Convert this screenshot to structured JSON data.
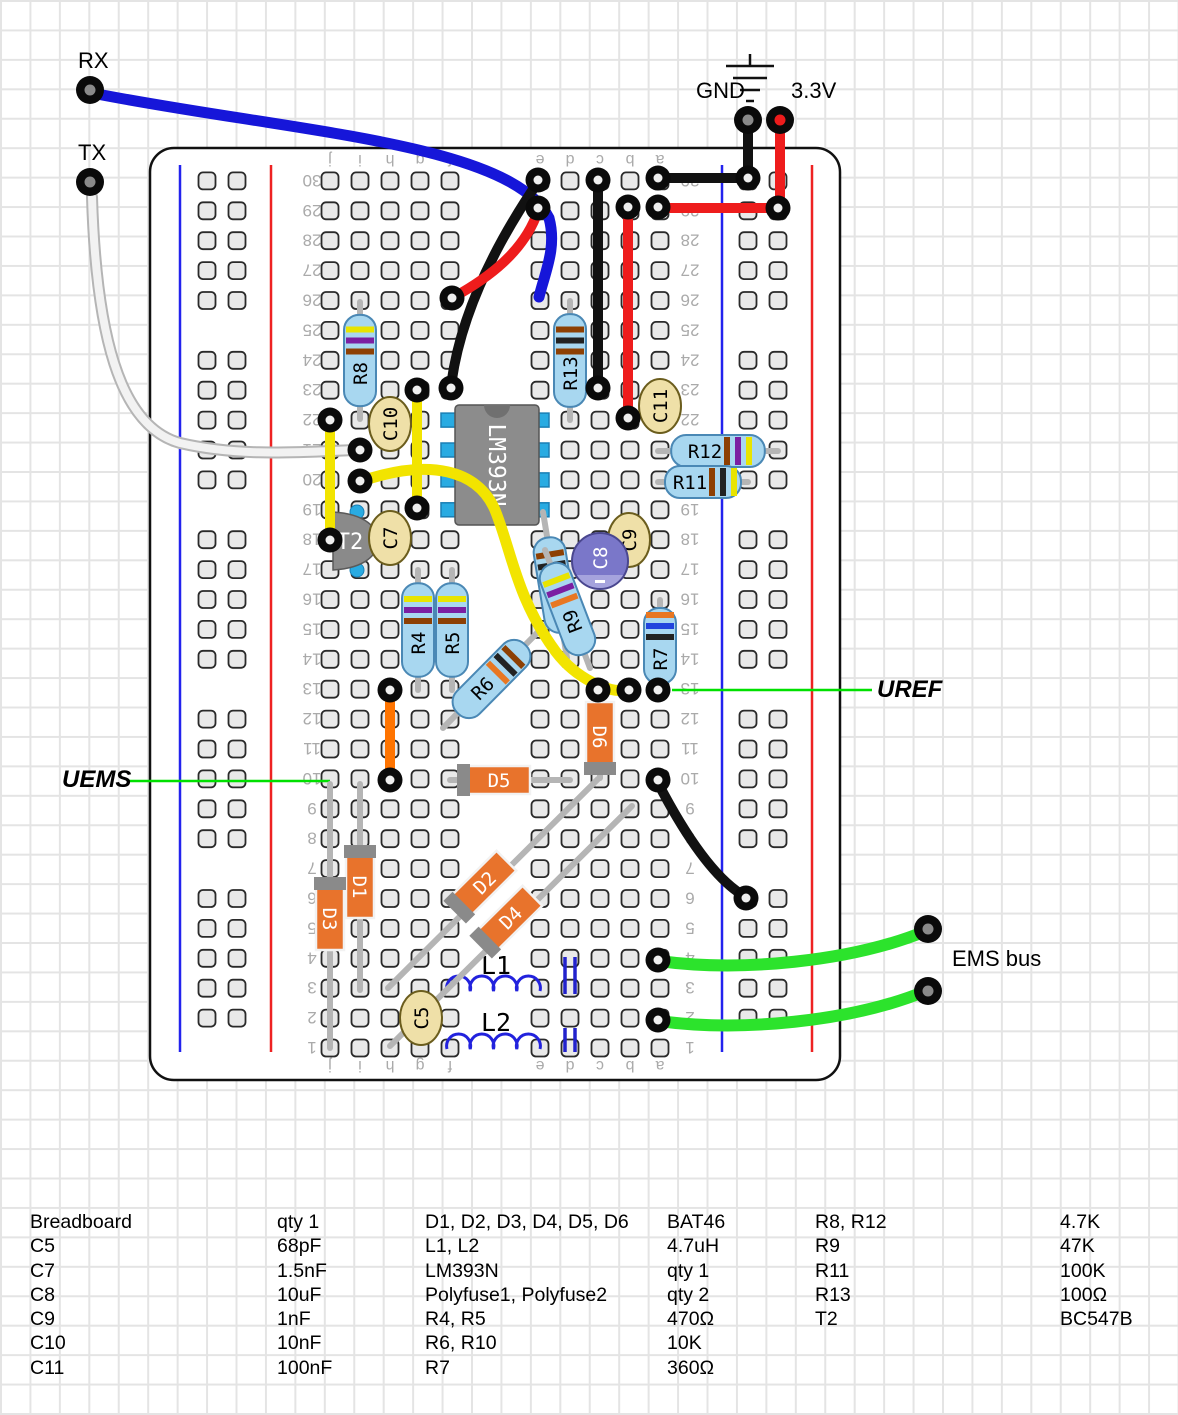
{
  "labels": {
    "rx": "RX",
    "tx": "TX",
    "gnd": "GND",
    "v33": "3.3V",
    "uref": "UREF",
    "uems": "UEMS",
    "ems_bus": "EMS bus"
  },
  "palette": {
    "wire_blue": "#1616d9",
    "wire_red": "#ee1c1c",
    "wire_black": "#111111",
    "wire_yellow": "#f2e400",
    "wire_green": "#2ce32c",
    "wire_orange": "#ff7400",
    "wire_white": "#f2f2f2",
    "annotation_green": "#00e000",
    "resistor_body": "#a8d7f0",
    "diode_body": "#e8732c",
    "cap_film": "#efe0a8",
    "cap_electrolytic": "#7a77c9",
    "ic_body": "#8c8c8c",
    "pin_blue": "#29abe2",
    "rail_blue": "#2222ee",
    "rail_red": "#ee2222"
  },
  "board": {
    "x": 150,
    "y": 148,
    "w": 690,
    "h": 932,
    "row_count": 30,
    "column_letters": [
      "j",
      "i",
      "h",
      "g",
      "f",
      "e",
      "d",
      "c",
      "b",
      "a"
    ]
  },
  "ic": {
    "label": "LM393N",
    "x": 497,
    "y": 465,
    "w": 84,
    "h": 120
  },
  "transistor": {
    "label": "T2",
    "x": 352,
    "y": 541
  },
  "resistors": [
    {
      "label": "R8",
      "p1": [
        360,
        302
      ],
      "p2": [
        360,
        419
      ],
      "side": -1,
      "bands": [
        "#e8e400",
        "#7b1fa2",
        "#8d4004"
      ]
    },
    {
      "label": "R13",
      "p1": [
        570,
        301
      ],
      "p2": [
        570,
        420
      ],
      "side": -1,
      "bands": [
        "#8d4004",
        "#222222",
        "#8d4004"
      ]
    },
    {
      "label": "R12",
      "p1": [
        658,
        451
      ],
      "p2": [
        778,
        451
      ],
      "side": 1,
      "bands": [
        "#8d4004",
        "#7b1fa2",
        "#e8e400"
      ]
    },
    {
      "label": "R11",
      "p1": [
        658,
        482
      ],
      "p2": [
        748,
        482
      ],
      "side": 1,
      "bands": [
        "#8d4004",
        "#222222",
        "#e8e400"
      ]
    },
    {
      "label": "R4",
      "p1": [
        418,
        570
      ],
      "p2": [
        418,
        690
      ],
      "side": -1,
      "bands": [
        "#e8e400",
        "#7b1fa2",
        "#8d4004"
      ]
    },
    {
      "label": "R5",
      "p1": [
        452,
        570
      ],
      "p2": [
        452,
        690
      ],
      "side": -1,
      "bands": [
        "#e8e400",
        "#7b1fa2",
        "#8d4004"
      ]
    },
    {
      "label": "R10",
      "p1": [
        543,
        512
      ],
      "p2": [
        567,
        658
      ],
      "side": -1,
      "bands": [
        "#8d4004",
        "#222222",
        "#e87722"
      ]
    },
    {
      "label": "R9",
      "p1": [
        545,
        550
      ],
      "p2": [
        590,
        668
      ],
      "side": -1,
      "bands": [
        "#e8e400",
        "#7b1fa2",
        "#e87722"
      ]
    },
    {
      "label": "R6",
      "p1": [
        540,
        630
      ],
      "p2": [
        443,
        728
      ],
      "side": -1,
      "bands": [
        "#8d4004",
        "#222222",
        "#e87722"
      ]
    },
    {
      "label": "R7",
      "p1": [
        660,
        600
      ],
      "p2": [
        660,
        692
      ],
      "side": -1,
      "bands": [
        "#e87722",
        "#2244dd",
        "#222222"
      ]
    }
  ],
  "diodes": [
    {
      "label": "D6",
      "p1": [
        600,
        692
      ],
      "p2": [
        600,
        778
      ],
      "bc": [
        600,
        735
      ],
      "band": "p2"
    },
    {
      "label": "D5",
      "p1": [
        450,
        780
      ],
      "p2": [
        570,
        780
      ],
      "bc": [
        497,
        780
      ],
      "band": "p1"
    },
    {
      "label": "D1",
      "p1": [
        360,
        784
      ],
      "p2": [
        360,
        990
      ],
      "bc": [
        360,
        885
      ],
      "band": "p1"
    },
    {
      "label": "D3",
      "p1": [
        330,
        784
      ],
      "p2": [
        330,
        1048
      ],
      "bc": [
        330,
        917
      ],
      "band": "p1"
    },
    {
      "label": "D2",
      "p1": [
        388,
        988
      ],
      "p2": [
        598,
        779
      ],
      "bc": [
        483,
        884
      ],
      "band": "p1"
    },
    {
      "label": "D4",
      "p1": [
        390,
        1046
      ],
      "p2": [
        632,
        806
      ],
      "bc": [
        509,
        919
      ],
      "band": "p1"
    }
  ],
  "capacitors": [
    {
      "label": "C10",
      "x": 390,
      "y": 424,
      "type": "film"
    },
    {
      "label": "C11",
      "x": 660,
      "y": 406,
      "type": "film"
    },
    {
      "label": "C7",
      "x": 390,
      "y": 538,
      "type": "film"
    },
    {
      "label": "C9",
      "x": 629,
      "y": 540,
      "type": "film"
    },
    {
      "label": "C5",
      "x": 421,
      "y": 1018,
      "type": "film"
    },
    {
      "label": "C8",
      "x": 600,
      "y": 561,
      "type": "electrolytic"
    }
  ],
  "inductors": [
    {
      "label": "L1",
      "x1": 447,
      "x2": 540,
      "y": 991,
      "lx": 496,
      "ly": 974
    },
    {
      "label": "L2",
      "x1": 447,
      "x2": 540,
      "y": 1049,
      "lx": 496,
      "ly": 1031
    }
  ],
  "polyfuses": [
    {
      "name": "polyfuse-1",
      "x": 570,
      "y1": 957,
      "y2": 994
    },
    {
      "name": "polyfuse-2",
      "x": 570,
      "y1": 1028,
      "y2": 1052
    }
  ],
  "wires": [
    {
      "name": "wire-rx-blue",
      "color": "#1616d9",
      "w": 11,
      "path": "M92,93 C290,132 510,142 549,218 C557,248 545,272 539,297"
    },
    {
      "name": "wire-tx-white",
      "color": "#f2f2f2",
      "w": 8,
      "outline": "#b5b5b5",
      "path": "M92,197 C96,330 118,426 180,443 C240,457 300,452 355,450"
    },
    {
      "name": "wire-gnd-drop",
      "color": "#111111",
      "w": 10,
      "path": "M748,122 L748,178"
    },
    {
      "name": "wire-gnd-a30",
      "color": "#111111",
      "w": 10,
      "path": "M658,178 L748,178"
    },
    {
      "name": "wire-black-c30-c23",
      "color": "#111111",
      "w": 10,
      "path": "M598,182 L598,388"
    },
    {
      "name": "wire-black-e30-f23",
      "color": "#111111",
      "w": 10,
      "path": "M538,182 C495,245 460,315 451,386"
    },
    {
      "name": "wire-black-a10-rail",
      "color": "#111111",
      "w": 10,
      "path": "M658,783 C685,835 715,880 746,897"
    },
    {
      "name": "wire-33v-drop",
      "color": "#ee1c1c",
      "w": 10,
      "path": "M780,122 L780,206"
    },
    {
      "name": "wire-red-a29-rail",
      "color": "#ee1c1c",
      "w": 10,
      "path": "M658,208 L778,208"
    },
    {
      "name": "wire-red-e29-f26",
      "color": "#ee1c1c",
      "w": 10,
      "path": "M538,211 C524,252 488,278 454,297"
    },
    {
      "name": "wire-red-b29-b22",
      "color": "#ee1c1c",
      "w": 10,
      "path": "M628,210 L628,418"
    },
    {
      "name": "wire-orange-h13-h10",
      "color": "#ff7400",
      "w": 10,
      "path": "M390,692 L390,778"
    },
    {
      "name": "wire-yellow-j22-j18",
      "color": "#f2e400",
      "w": 10,
      "path": "M330,420 L330,540"
    },
    {
      "name": "wire-yellow-g23-g19",
      "color": "#f2e400",
      "w": 10,
      "path": "M417,392 L417,506"
    },
    {
      "name": "wire-yellow-i20-b13",
      "color": "#f2e400",
      "w": 11,
      "path": "M362,481 C430,458 478,470 495,510 C512,552 516,598 556,652 C576,678 608,694 629,690"
    },
    {
      "name": "wire-green-a4-ems",
      "color": "#2ce32c",
      "w": 12,
      "path": "M659,961 C740,972 850,962 926,931"
    },
    {
      "name": "wire-green-a2-ems",
      "color": "#2ce32c",
      "w": 12,
      "path": "M659,1021 C740,1032 850,1022 926,991"
    }
  ],
  "pin_rings": [
    [
      538,
      180
    ],
    [
      538,
      208
    ],
    [
      598,
      180
    ],
    [
      658,
      178
    ],
    [
      748,
      178
    ],
    [
      628,
      207
    ],
    [
      658,
      207
    ],
    [
      778,
      208
    ],
    [
      451,
      388
    ],
    [
      452,
      298
    ],
    [
      598,
      388
    ],
    [
      628,
      418
    ],
    [
      330,
      420
    ],
    [
      330,
      540
    ],
    [
      417,
      390
    ],
    [
      417,
      508
    ],
    [
      360,
      450
    ],
    [
      360,
      481
    ],
    [
      629,
      690
    ],
    [
      658,
      690
    ],
    [
      598,
      690
    ],
    [
      390,
      690
    ],
    [
      390,
      780
    ],
    [
      658,
      780
    ],
    [
      746,
      898
    ],
    [
      658,
      960
    ],
    [
      658,
      1020
    ]
  ],
  "ext_pins": [
    {
      "name": "rx-pin",
      "x": 90,
      "y": 90
    },
    {
      "name": "tx-pin",
      "x": 90,
      "y": 182
    },
    {
      "name": "gnd-pin",
      "x": 748,
      "y": 120
    },
    {
      "name": "v33-pin",
      "x": 780,
      "y": 120
    },
    {
      "name": "ems-pin-1",
      "x": 928,
      "y": 929
    },
    {
      "name": "ems-pin-2",
      "x": 928,
      "y": 991
    }
  ],
  "annotation_lines": [
    {
      "name": "uems-line",
      "x1": 128,
      "y1": 781,
      "x2": 330,
      "y2": 781
    },
    {
      "name": "uref-line",
      "x1": 672,
      "y1": 690,
      "x2": 872,
      "y2": 690
    }
  ],
  "parts_list": [
    {
      "x_name": 30,
      "x_value": 277,
      "rows": [
        [
          "Breadboard",
          "qty 1"
        ],
        [
          "C5",
          "68pF"
        ],
        [
          "C7",
          "1.5nF"
        ],
        [
          "C8",
          "10uF"
        ],
        [
          "C9",
          "1nF"
        ],
        [
          "C10",
          "10nF"
        ],
        [
          "C11",
          "100nF"
        ]
      ]
    },
    {
      "x_name": 425,
      "x_value": 667,
      "rows": [
        [
          "D1, D2, D3, D4, D5, D6",
          "BAT46"
        ],
        [
          "L1, L2",
          "4.7uH"
        ],
        [
          "LM393N",
          "qty 1"
        ],
        [
          "Polyfuse1, Polyfuse2",
          "qty 2"
        ],
        [
          "R4, R5",
          "470Ω"
        ],
        [
          "R6, R10",
          "10K"
        ],
        [
          "R7",
          "360Ω"
        ]
      ]
    },
    {
      "x_name": 815,
      "x_value": 1060,
      "rows": [
        [
          "R8, R12",
          "4.7K"
        ],
        [
          "R9",
          "47K"
        ],
        [
          "R11",
          "100K"
        ],
        [
          "R13",
          "100Ω"
        ],
        [
          "T2",
          "BC547B"
        ]
      ]
    }
  ]
}
